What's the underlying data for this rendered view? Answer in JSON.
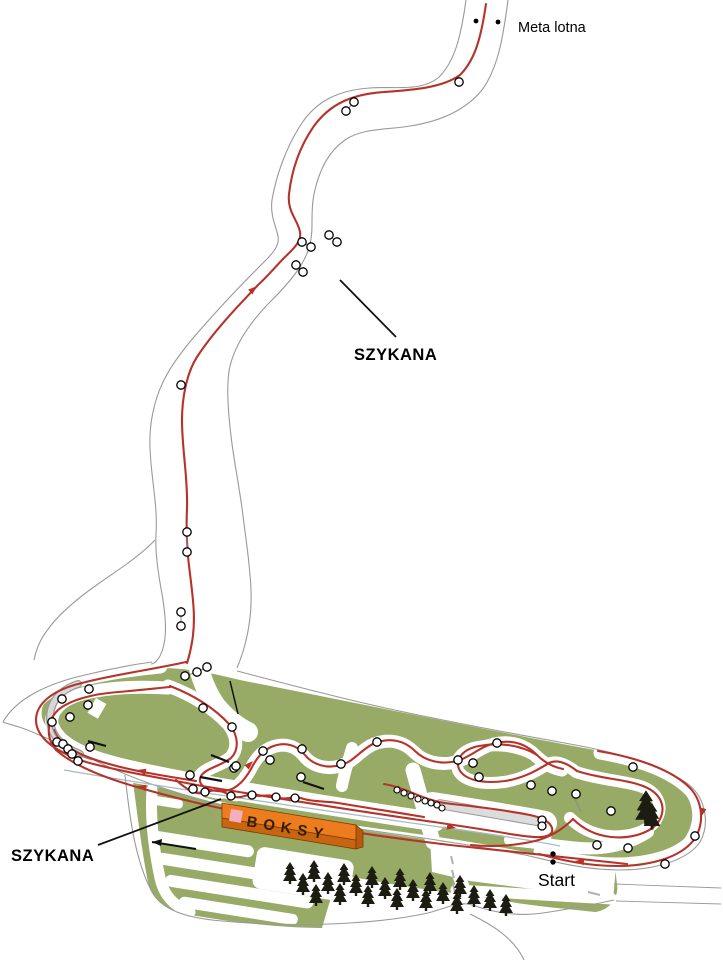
{
  "map": {
    "labels": {
      "meta_lotna": "Meta lotna",
      "szykana_top": "SZYKANA",
      "szykana_bottom": "SZYKANA",
      "boksy": "BOKSY",
      "start": "Start"
    },
    "colors": {
      "route_red": "#b5332a",
      "grass_green": "#98ab66",
      "road_outline_gray": "#999999",
      "barrier_gray": "#d8d8d8",
      "boksy_orange": "#ed7c1e",
      "boksy_front_orange": "#c96410",
      "boksy_pink": "#f2afc0",
      "tree_black": "#1c1c12",
      "divider_blue": "#a4bac4",
      "label_black": "#000000"
    },
    "icons": {
      "gate_marker": "white-circle-black-ring",
      "start_line_dot": "black-dot",
      "finish_line_dot": "black-dot",
      "tree": "pine-silhouette",
      "direction_arrow": "red-triangle"
    }
  }
}
